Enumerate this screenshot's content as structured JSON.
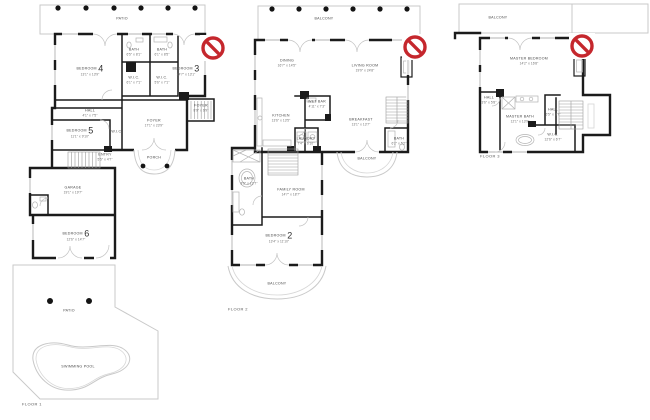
{
  "meta": {
    "type": "real-estate floor plan sheet",
    "colors": {
      "wall": "#1b1b1b",
      "light_line": "#c9c9c9",
      "no_sign_red": "#c5272d",
      "label_text": "#4a4a4a",
      "background": "#ffffff"
    }
  },
  "icons": {
    "no_photo": "prohibition-sign"
  },
  "floor1": {
    "floor_label": "FLOOR 1",
    "patio_top": "PATIO",
    "patio_lower": "PATIO",
    "pool": "SWIMMING POOL",
    "porch": "PORCH",
    "bedroom4": {
      "name": "BEDROOM",
      "num": "4",
      "dims": "13'1\" x 13'9\""
    },
    "bedroom3": {
      "name": "BEDROOM",
      "num": "3",
      "dims": "14'7\" x 13'1\""
    },
    "bedroom5": {
      "name": "BEDROOM",
      "num": "5",
      "dims": "11'1\" x 9'10\""
    },
    "bedroom6": {
      "name": "BEDROOM",
      "num": "6",
      "dims": "12'6\" x 14'7\""
    },
    "bath1": {
      "name": "BATH",
      "dims": "6'5\" x 8'1\""
    },
    "bath2": {
      "name": "BATH",
      "dims": "6'1\" x 8'5\""
    },
    "wic1": {
      "name": "W.I.C.",
      "dims": "6'1\" x 7'1\""
    },
    "wic2": {
      "name": "W.I.C.",
      "dims": "5'6\" x 7'1\""
    },
    "wic3": {
      "name": "W.I.C."
    },
    "hall": {
      "name": "HALL",
      "dims": "4'1\" x 7'5\""
    },
    "entry": {
      "name": "ENTRY",
      "dims": "5'5\" x 4'7\""
    },
    "foyer": {
      "name": "FOYER",
      "dims": "17'1\" x 23'9\""
    },
    "foyer_small": {
      "name": "FOYER",
      "dims": "8'9\" x 6'9\""
    },
    "garage": {
      "name": "GARAGE",
      "dims": "19'1\" x 19'7\""
    }
  },
  "floor2": {
    "floor_label": "FLOOR 2",
    "balcony_top": "BALCONY",
    "balcony_mid": "BALCONY",
    "balcony_bottom": "BALCONY",
    "dining": {
      "name": "DINING",
      "dims": "16'7\" x 14'5\""
    },
    "living": {
      "name": "LIVING ROOM",
      "dims": "19'9\" x 24'8\""
    },
    "kitchen": {
      "name": "KITCHEN",
      "dims": "13'6\" x 13'5\""
    },
    "wetbar": {
      "name": "WET BAR",
      "dims": "4'11\" x 7'3\""
    },
    "breakfast": {
      "name": "BREAKFAST",
      "dims": "13'1\" x 13'7\""
    },
    "laundry": {
      "name": "LAUNDRY",
      "dims": "7'4\" x 6'10\""
    },
    "bath_up": {
      "name": "BATH",
      "dims": "6'2\" x 5'2\""
    },
    "bath_low": {
      "name": "BATH",
      "dims": "8'5\" x 12'7\""
    },
    "family": {
      "name": "FAMILY ROOM",
      "dims": "14'7\" x 18'7\""
    },
    "bedroom2": {
      "name": "BEDROOM",
      "num": "2",
      "dims": "13'4\" x 11'10\""
    }
  },
  "floor3": {
    "floor_label": "FLOOR 3",
    "balcony_top": "BALCONY",
    "master_bedroom": {
      "name": "MASTER BEDROOM",
      "dims": "14'2\" x 16'8\""
    },
    "master_bath": {
      "name": "MASTER BATH",
      "dims": "12'1\" x 13'9\""
    },
    "hall_small": {
      "name": "HALL",
      "dims": "3'6\" x 5'8\""
    },
    "hall": {
      "name": "HALL",
      "dims": "6'5\" x 8'7\""
    },
    "wic": {
      "name": "W.I.C.",
      "dims": "12'6\" x 6'7\""
    }
  }
}
